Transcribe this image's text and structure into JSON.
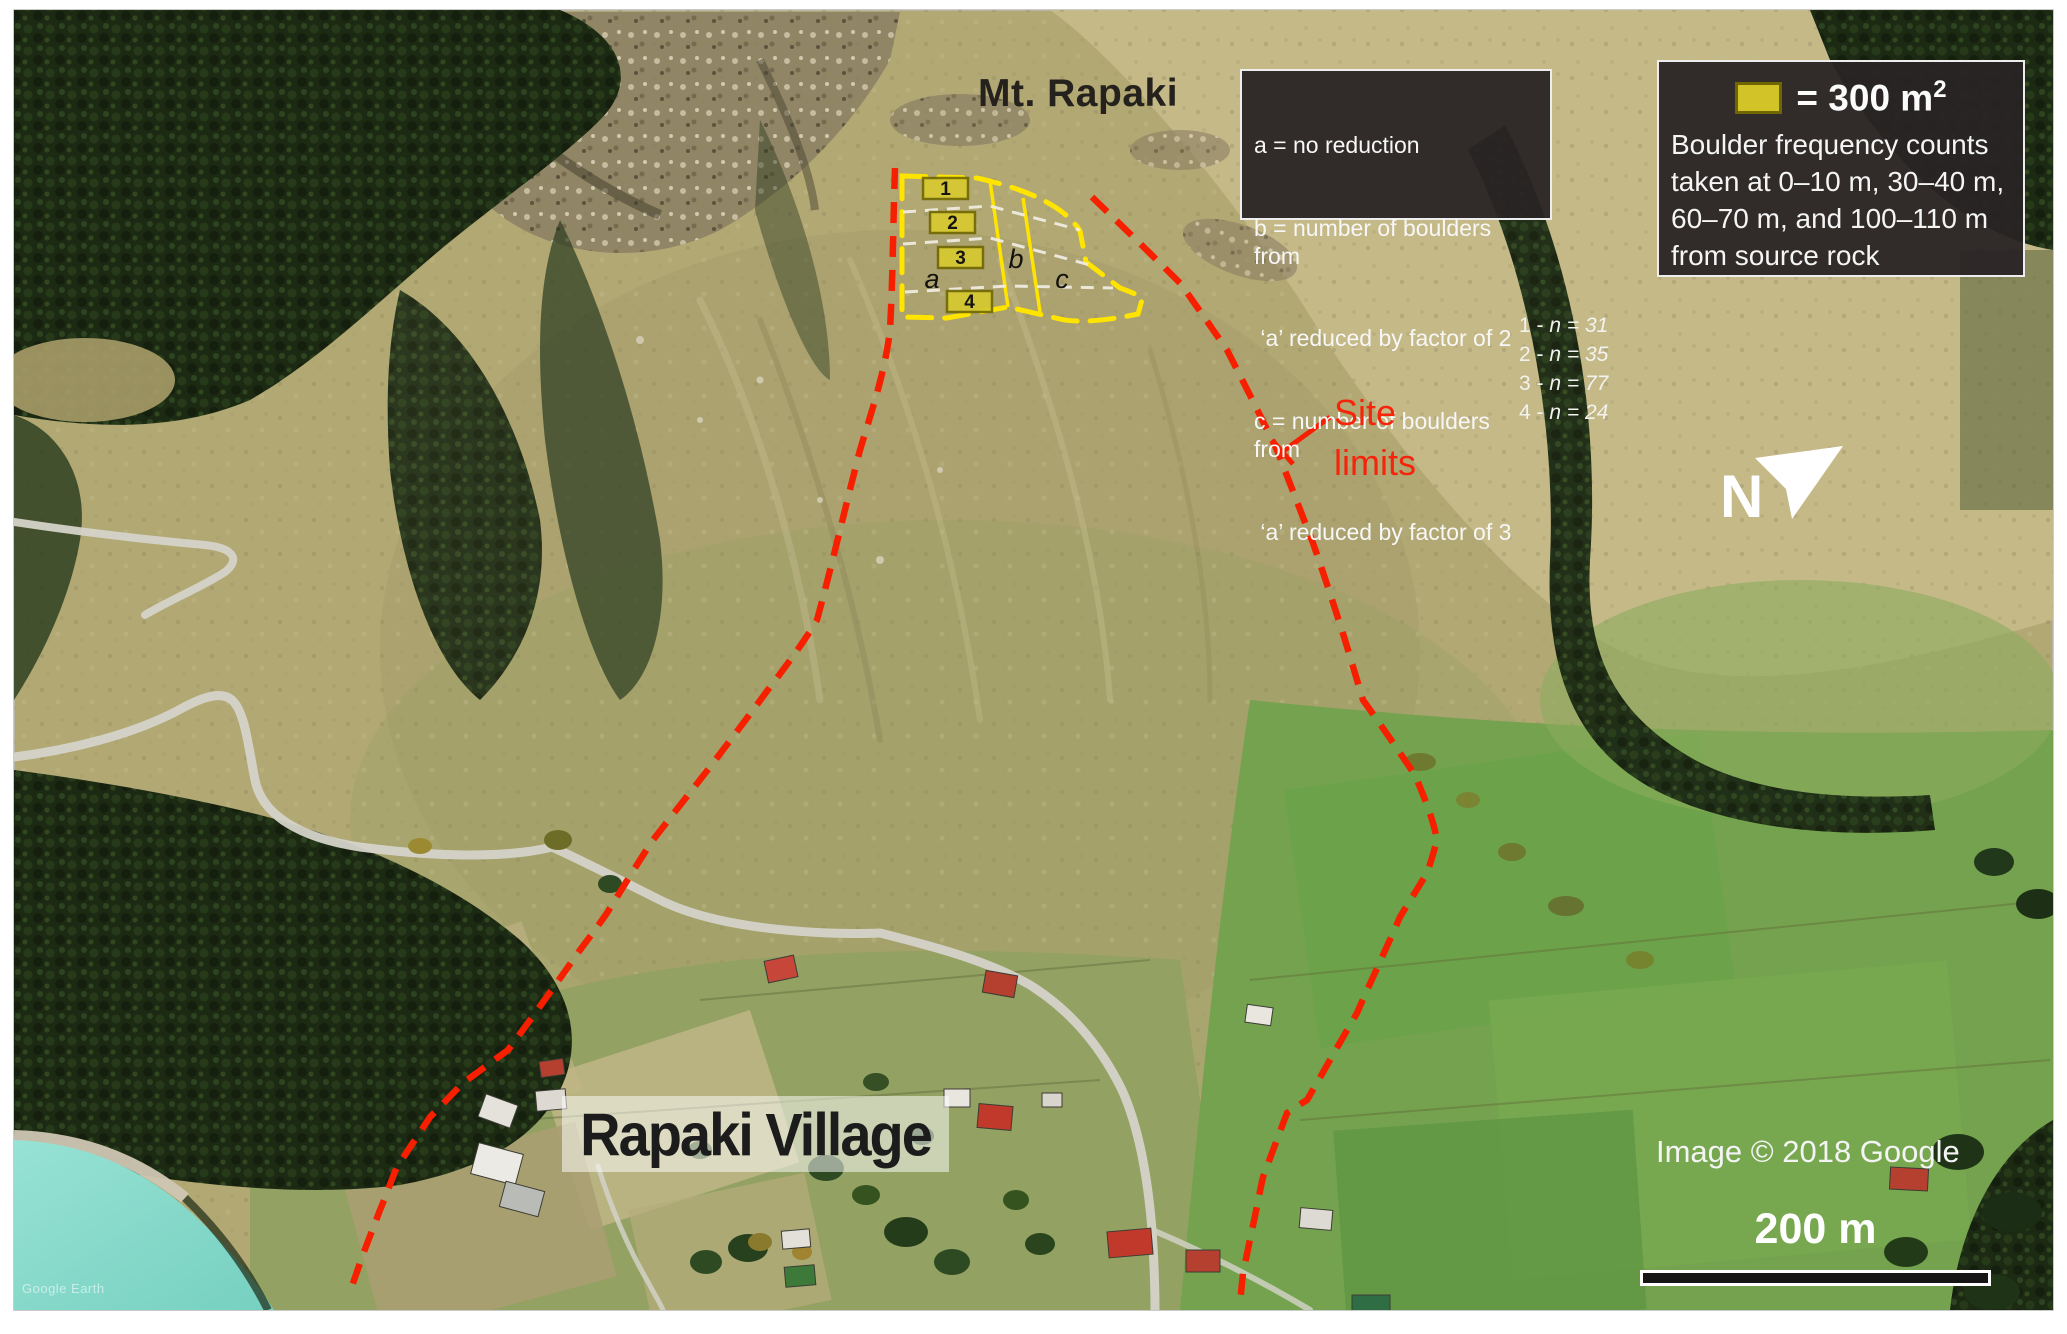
{
  "annotations": {
    "mountain_label": "Mt. Rapaki",
    "village_label": "Rapaki Village",
    "site_limits": {
      "line1": "Site",
      "line2": "limits"
    },
    "north_label": "N",
    "attribution": "Image © 2018 Google",
    "watermark": "Google Earth",
    "scale_bar_label": "200 m"
  },
  "legend_reduction": {
    "lines": [
      "a = no reduction",
      "b = number of boulders from",
      " ‘a’ reduced by factor of 2",
      "c = number of boulders from",
      " ‘a’ reduced by factor of 3"
    ]
  },
  "legend_area": {
    "equals_text": "= 300 m",
    "exponent": "2",
    "lines": [
      "Boulder frequency counts",
      "taken at 0–10 m, 30–40 m,",
      "60–70 m, and 100–110 m",
      "from source rock"
    ]
  },
  "boulder_counts": {
    "rows": [
      {
        "prefix": "1 - ",
        "expr": "n = 31"
      },
      {
        "prefix": "2 - ",
        "expr": "n = 35"
      },
      {
        "prefix": "3 - ",
        "expr": "n = 77"
      },
      {
        "prefix": "4 - ",
        "expr": "n = 24"
      }
    ]
  },
  "plots": {
    "p1": "1",
    "p2": "2",
    "p3": "3",
    "p4": "4",
    "zone_a": "a",
    "zone_b": "b",
    "zone_c": "c"
  },
  "colors": {
    "site_limit_red": "#f62000",
    "plot_outline_yellow": "#ffe400",
    "plot_fill_yellow": "#d8ca2e",
    "legend_swatch_yellow": "#d2c428",
    "legend_background": "#292425",
    "water_turquoise": "#85d9c9"
  }
}
